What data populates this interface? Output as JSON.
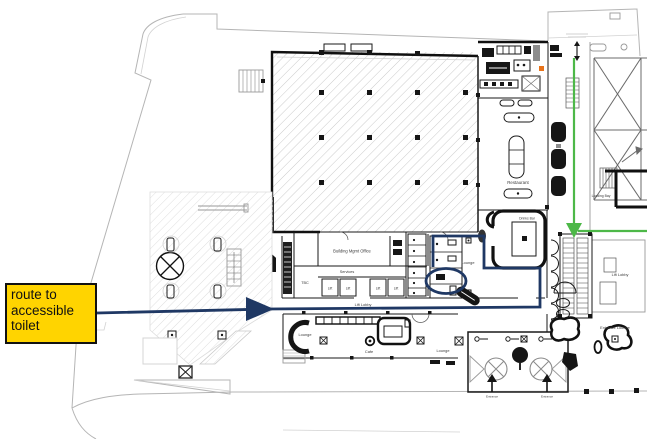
{
  "annotation": {
    "text": "route to accessible toilet"
  },
  "colors": {
    "route_navy": "#1f3864",
    "route_green": "#4db848",
    "annotation_yellow": "#ffd400",
    "equipment_orange": "#e8731a"
  },
  "plan": {
    "labels": {
      "building_office": "Building Mgmt Office",
      "services": "Services",
      "tbc": "TBC",
      "lifts": [
        "Lift",
        "Lift",
        "Lift",
        "Lift"
      ],
      "lift_lobby_main": "Lift Lobby",
      "lift_lobby_right": "Lift Lobby",
      "restaurant": "Restaurant",
      "drinks_bar": "Drinks Bar",
      "lounge_mid": "Lounge",
      "lounge_left": "Lounge",
      "lounge_right": "Lounge",
      "cafe": "Cafe",
      "entrance_lounge": "Entrance Lounge",
      "loading_bay": "Loading Bay",
      "entrances": [
        "Entrance",
        "Entrance"
      ]
    }
  }
}
